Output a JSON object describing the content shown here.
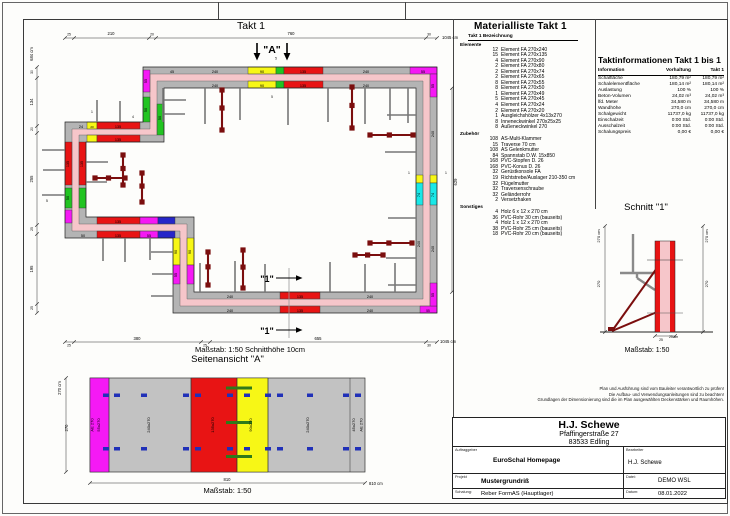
{
  "sheet": {
    "takt_title": "Takt 1"
  },
  "plan": {
    "caption": "Maßstab: 1:50   Schnitthöhe 10cm",
    "labels": [
      {
        "t": "25",
        "x": 44,
        "y": 23.5,
        "s": 3.4
      },
      {
        "t": "210",
        "x": 86,
        "y": 23,
        "s": 4.2
      },
      {
        "t": "20",
        "x": 127,
        "y": 23.5,
        "s": 3.4
      },
      {
        "t": "760",
        "x": 266,
        "y": 23,
        "s": 4.2
      },
      {
        "t": "30",
        "x": 404,
        "y": 23.5,
        "s": 3.4
      },
      {
        "t": "1045 cm",
        "x": 417,
        "y": 27,
        "s": 4.2,
        "a": "start"
      },
      {
        "t": "684 cm",
        "x": 8,
        "y": 42,
        "r": -90,
        "s": 4.2
      },
      {
        "t": "30",
        "x": 8,
        "y": 60,
        "r": -90,
        "s": 3.4
      },
      {
        "t": "134",
        "x": 8,
        "y": 90,
        "r": -90,
        "s": 4.2
      },
      {
        "t": "20",
        "x": 8,
        "y": 117,
        "r": -90,
        "s": 3.4
      },
      {
        "t": "255",
        "x": 8,
        "y": 167,
        "r": -90,
        "s": 4.2
      },
      {
        "t": "25",
        "x": 8,
        "y": 217,
        "r": -90,
        "s": 3.4
      },
      {
        "t": "195",
        "x": 8,
        "y": 257,
        "r": -90,
        "s": 4.2
      },
      {
        "t": "25",
        "x": 8,
        "y": 296,
        "r": -90,
        "s": 3.4
      },
      {
        "t": "25",
        "x": 44,
        "y": 334.5,
        "s": 3.4
      },
      {
        "t": "380",
        "x": 112,
        "y": 328,
        "s": 4.2
      },
      {
        "t": "25",
        "x": 180,
        "y": 334.5,
        "s": 3.4
      },
      {
        "t": "655",
        "x": 293,
        "y": 328,
        "s": 4.2
      },
      {
        "t": "30",
        "x": 404,
        "y": 334.5,
        "s": 3.4
      },
      {
        "t": "1045 cm",
        "x": 415,
        "y": 331,
        "s": 4.2,
        "a": "start"
      },
      {
        "t": "629",
        "x": 432,
        "y": 170,
        "r": -90,
        "s": 4.2
      },
      {
        "t": "\"A\"",
        "x": 247,
        "y": 41,
        "s": 10.5,
        "b": 1
      },
      {
        "t": "5",
        "x": 251,
        "y": 47.5,
        "s": 3.2
      },
      {
        "t": "5",
        "x": 247,
        "y": 86,
        "s": 3.2
      },
      {
        "t": "\"1\"",
        "x": 242,
        "y": 270,
        "s": 9,
        "b": 1
      },
      {
        "t": "\"1\"",
        "x": 242,
        "y": 322,
        "s": 9,
        "b": 1
      },
      {
        "t": "1",
        "x": 67,
        "y": 101,
        "s": 3.4
      },
      {
        "t": "4",
        "x": 108,
        "y": 106,
        "s": 3.4
      },
      {
        "t": "5",
        "x": 22,
        "y": 190,
        "s": 3.4
      },
      {
        "t": "1",
        "x": 384,
        "y": 162,
        "s": 3.4
      },
      {
        "t": "1",
        "x": 421,
        "y": 162,
        "s": 3.4
      },
      {
        "t": "45",
        "x": 147,
        "y": 60.8
      },
      {
        "t": "240",
        "x": 190,
        "y": 60.8
      },
      {
        "t": "90",
        "x": 237,
        "y": 60.8
      },
      {
        "t": "135",
        "x": 278,
        "y": 60.8
      },
      {
        "t": "240",
        "x": 341,
        "y": 60.8
      },
      {
        "t": "55",
        "x": 398,
        "y": 60.8
      },
      {
        "t": "240",
        "x": 190,
        "y": 74.8
      },
      {
        "t": "90",
        "x": 237,
        "y": 74.8
      },
      {
        "t": "135",
        "x": 278,
        "y": 74.8
      },
      {
        "t": "240",
        "x": 341,
        "y": 74.8
      },
      {
        "t": "55",
        "x": 121.8,
        "y": 69,
        "r": -90
      },
      {
        "t": "50",
        "x": 121.8,
        "y": 98,
        "r": -90
      },
      {
        "t": "50",
        "x": 135.8,
        "y": 106,
        "r": -90
      },
      {
        "t": "24",
        "x": 56,
        "y": 115.8
      },
      {
        "t": "20",
        "x": 67,
        "y": 115.8,
        "s": 3
      },
      {
        "t": "135",
        "x": 93,
        "y": 115.8
      },
      {
        "t": "135",
        "x": 93,
        "y": 128.8
      },
      {
        "t": "135",
        "x": 43.8,
        "y": 152,
        "r": -90
      },
      {
        "t": "50",
        "x": 43.8,
        "y": 186,
        "r": -90
      },
      {
        "t": "135",
        "x": 57.8,
        "y": 152,
        "r": -90
      },
      {
        "t": "50",
        "x": 58,
        "y": 224.8
      },
      {
        "t": "135",
        "x": 93,
        "y": 224.8
      },
      {
        "t": "55",
        "x": 124,
        "y": 224.8
      },
      {
        "t": "135",
        "x": 93,
        "y": 210.8
      },
      {
        "t": "90",
        "x": 151.8,
        "y": 240,
        "r": -90
      },
      {
        "t": "55",
        "x": 151.8,
        "y": 263,
        "r": -90
      },
      {
        "t": "90",
        "x": 165.8,
        "y": 240,
        "r": -90
      },
      {
        "t": "240",
        "x": 205,
        "y": 299.8
      },
      {
        "t": "135",
        "x": 275,
        "y": 299.8
      },
      {
        "t": "240",
        "x": 345,
        "y": 299.8
      },
      {
        "t": "55",
        "x": 403,
        "y": 299.8,
        "s": 3.2
      },
      {
        "t": "240",
        "x": 205,
        "y": 285.8
      },
      {
        "t": "135",
        "x": 275,
        "y": 285.8
      },
      {
        "t": "240",
        "x": 345,
        "y": 285.8
      },
      {
        "t": "55",
        "x": 408.8,
        "y": 74,
        "r": -90
      },
      {
        "t": "240",
        "x": 408.8,
        "y": 122,
        "r": -90
      },
      {
        "t": "74",
        "x": 408.8,
        "y": 183,
        "r": -90
      },
      {
        "t": "240",
        "x": 408.8,
        "y": 237,
        "r": -90
      },
      {
        "t": "55",
        "x": 408.8,
        "y": 283,
        "r": -90
      },
      {
        "t": "74",
        "x": 394.8,
        "y": 183,
        "r": -90
      },
      {
        "t": "240",
        "x": 394.8,
        "y": 232,
        "r": -90
      }
    ]
  },
  "side_view": {
    "title": "Seitenansicht \"A\"",
    "caption": "Maßstab: 1:50",
    "labels": [
      {
        "t": "AE 270",
        "x": 38.5,
        "y": 67,
        "r": -90,
        "s": 4
      },
      {
        "t": "55x270",
        "x": 45,
        "y": 67,
        "r": -90,
        "s": 4
      },
      {
        "t": "240x270",
        "x": 95,
        "y": 67,
        "r": -90,
        "s": 4
      },
      {
        "t": "135x270",
        "x": 159,
        "y": 67,
        "r": -90,
        "s": 4
      },
      {
        "t": "90x270",
        "x": 197,
        "y": 67,
        "r": -90,
        "s": 4
      },
      {
        "t": "240x270",
        "x": 254,
        "y": 67,
        "r": -90,
        "s": 4
      },
      {
        "t": "45x270",
        "x": 300,
        "y": 67,
        "r": -90,
        "s": 4
      },
      {
        "t": "AE 270",
        "x": 307.5,
        "y": 67,
        "r": -90,
        "s": 4
      },
      {
        "t": "270 cm",
        "x": 6,
        "y": 30,
        "r": -90,
        "s": 4.2
      },
      {
        "t": "270",
        "x": 13,
        "y": 70,
        "r": -90,
        "s": 4.2
      },
      {
        "t": "810",
        "x": 172,
        "y": 123,
        "s": 4.2
      },
      {
        "t": "810 cm",
        "x": 314,
        "y": 127,
        "s": 4.2,
        "a": "start"
      }
    ]
  },
  "section_view": {
    "title": "Schnitt \"1\"",
    "caption": "Maßstab: 1:50",
    "labels": [
      {
        "t": "270 cm",
        "x": 5,
        "y": 16,
        "r": -90,
        "s": 4
      },
      {
        "t": "270",
        "x": 5,
        "y": 64,
        "r": -90,
        "s": 4
      },
      {
        "t": "270 cm",
        "x": 113,
        "y": 16,
        "r": -90,
        "s": 4
      },
      {
        "t": "270",
        "x": 113,
        "y": 64,
        "r": -90,
        "s": 4
      },
      {
        "t": "25",
        "x": 66,
        "y": 121,
        "s": 3.4
      },
      {
        "t": "25 cm",
        "x": 74,
        "y": 118,
        "s": 3.4,
        "a": "start"
      }
    ]
  },
  "material_list": {
    "title": "Materialliste  Takt 1",
    "header": "Takt 1  Bezeichnung",
    "groups": [
      {
        "name": "Elemente",
        "rows": [
          {
            "qty": "12",
            "label": "Element FA 270x240"
          },
          {
            "qty": "15",
            "label": "Element FA 270x135"
          },
          {
            "qty": "4",
            "label": "Element FA 270x90"
          },
          {
            "qty": "2",
            "label": "Element FA 270x80"
          },
          {
            "qty": "2",
            "label": "Element FA 270x74"
          },
          {
            "qty": "2",
            "label": "Element FA 270x65"
          },
          {
            "qty": "8",
            "label": "Element FA 270x55"
          },
          {
            "qty": "8",
            "label": "Element FA 270x50"
          },
          {
            "qty": "1",
            "label": "Element FA 270x49"
          },
          {
            "qty": "5",
            "label": "Element FA 270x45"
          },
          {
            "qty": "4",
            "label": "Element FA 270x24"
          },
          {
            "qty": "2",
            "label": "Element FA 270x20"
          },
          {
            "qty": "1",
            "label": "Ausgleichshölzer 4x13x270"
          },
          {
            "qty": "8",
            "label": "Inneneckwinkel 270x25x25"
          },
          {
            "qty": "8",
            "label": "Außeneckwinkel 270"
          }
        ]
      },
      {
        "name": "Zubehör",
        "rows": [
          {
            "qty": "108",
            "label": "AS-Multi-Klammer"
          },
          {
            "qty": "15",
            "label": "Traverse 70 cm"
          },
          {
            "qty": "108",
            "label": "AS Gelenkmutter"
          },
          {
            "qty": "84",
            "label": "Spannstab D.W. 15x850"
          },
          {
            "qty": "168",
            "label": "PVC-Stopfen D. 26"
          },
          {
            "qty": "168",
            "label": "PVC-Konus D. 26"
          },
          {
            "qty": "32",
            "label": "Gerüstkonsole FA"
          },
          {
            "qty": "19",
            "label": "Richtstrebe/Auslager 210-350 cm"
          },
          {
            "qty": "32",
            "label": "Flügelmutter"
          },
          {
            "qty": "32",
            "label": "Traversenschraube"
          },
          {
            "qty": "32",
            "label": "Geländerrohr"
          },
          {
            "qty": "2",
            "label": "Versetzhaken"
          }
        ]
      },
      {
        "name": "Sonstiges",
        "rows": [
          {
            "qty": "4",
            "label": "Holz 6 x 12 x 270 cm"
          },
          {
            "qty": "36",
            "label": "PVC-Rohr 30 cm (bauseits)"
          },
          {
            "qty": "4",
            "label": "Holz 1 x 12 x 270 cm"
          },
          {
            "qty": "38",
            "label": "PVC-Rohr 25 cm (bauseits)"
          },
          {
            "qty": "18",
            "label": "PVC-Rohr 20 cm (bauseits)"
          }
        ]
      }
    ]
  },
  "takt_info": {
    "title": "Taktinformationen  Takt 1 bis 1",
    "columns": {
      "c1": "Information",
      "c2": "Vorhaltung",
      "c3": "Takt 1"
    },
    "rows": [
      {
        "name": "Schalfläche",
        "v1": "180,79 m²",
        "v2": "180,79 m²"
      },
      {
        "name": "Schalelementfläche",
        "v1": "180,14 m²",
        "v2": "180,14 m²"
      },
      {
        "name": "Auslastung",
        "v1": "100 %",
        "v2": "100 %"
      },
      {
        "name": "Beton-Volumen",
        "v1": "24,02 m³",
        "v2": "24,02 m³"
      },
      {
        "name": "lfd. Meter",
        "v1": "34,580 m",
        "v2": "34,580 m"
      },
      {
        "name": "Wandhöhe",
        "v1": "270,0 cm",
        "v2": "270,0 cm"
      },
      {
        "name": "Schalgewicht",
        "v1": "11737,0 kg",
        "v2": "11737,0 kg"
      },
      {
        "name": "Einschalzeit",
        "v1": "0:00 Std.",
        "v2": "0:00 Std."
      },
      {
        "name": "Ausschalzeit",
        "v1": "0:00 Std.",
        "v2": "0:00 Std."
      },
      {
        "name": "Schalungspreis",
        "v1": "0,00 €",
        "v2": "0,00 €"
      }
    ]
  },
  "disclaimer": {
    "lines": [
      "Plan und Ausführung sind vom Bauleiter verantwortlich zu prüfen!",
      "Die Aufbau- und Verwendungsanleitungen sind zu beachten!",
      "Grundlagen der Dimensionierung sind die im Plan ausgewählten Deckenstärken und Raumhöhen."
    ]
  },
  "title_block": {
    "company": "H.J. Schewe",
    "street": "Pfaffingerstraße 27",
    "city": "83533 Edling",
    "client_label": "Auftraggeber",
    "client": "EuroSchal Homepage",
    "editor_label": "Bearbeiter",
    "editor": "H.J. Schewe",
    "project_label": "Projekt",
    "project": "Mustergrundriß",
    "file_label": "Datei:",
    "file": "DEMO WSL",
    "formwork_label": "Schalung:",
    "formwork": "Reber FormAS (Hauptlager)",
    "date_label": "Datum:",
    "date": "08.01.2022"
  },
  "colors": {
    "wall_pink": "#f6c6ca",
    "element_red": "#e81414",
    "band_gray": "#b4b4b4",
    "magenta": "#f519f5",
    "yellow": "#f7f716",
    "green": "#21c421",
    "cyan": "#19e8e8",
    "blue": "#2626c9",
    "tie_darkred": "#7b0e0e"
  }
}
